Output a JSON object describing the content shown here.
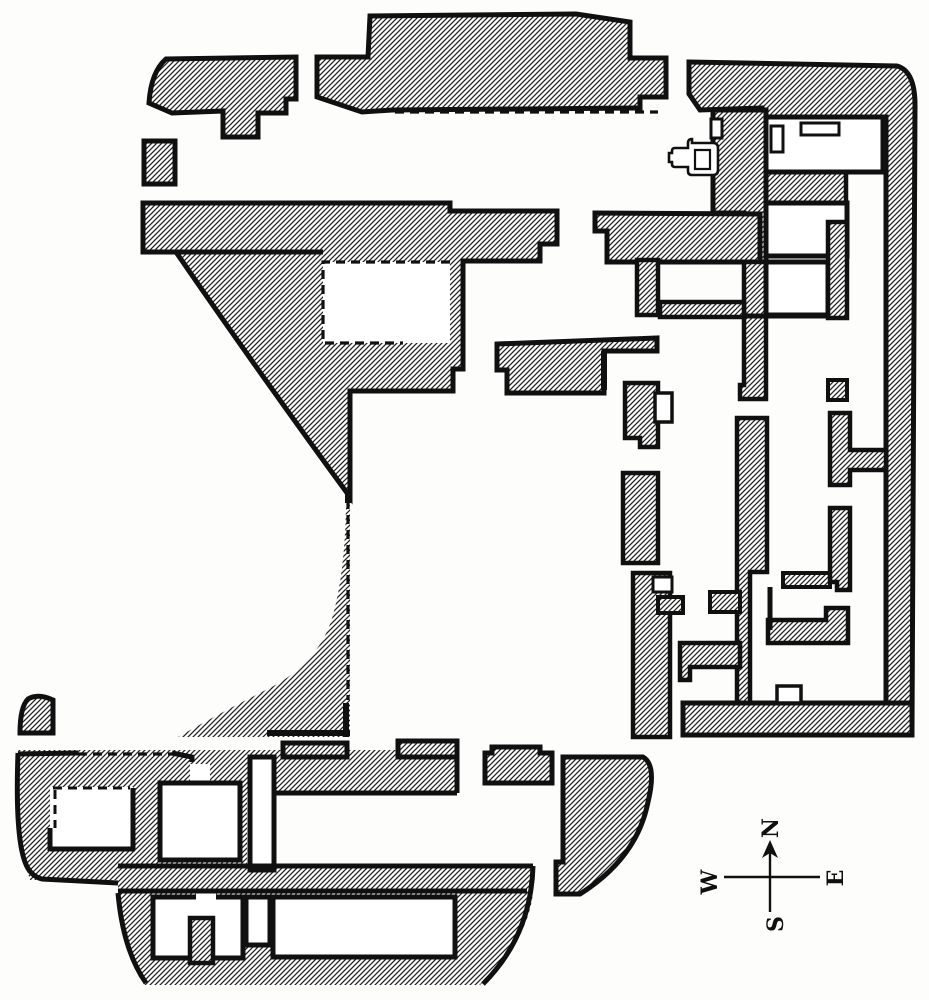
{
  "figure": {
    "title": "Excavated building floor plan (scanned engraving)",
    "canvas": {
      "width": 929,
      "height": 1000
    },
    "colors": {
      "paper": "#fdfdfc",
      "ink": "#101010",
      "hatch_line": "#222222"
    },
    "hatch": {
      "tile": 5,
      "line_width": 1.3,
      "direction": "diagonal-rising-right"
    }
  },
  "compass": {
    "font_size": 22,
    "letters": [
      {
        "dir": "north",
        "char": "N",
        "x": 772,
        "y": 828,
        "rot": -90
      },
      {
        "dir": "south",
        "char": "S",
        "x": 777,
        "y": 924,
        "rot": -90
      },
      {
        "dir": "west",
        "char": "W",
        "x": 711,
        "y": 882,
        "rot": -90
      },
      {
        "dir": "east",
        "char": "E",
        "x": 837,
        "y": 878,
        "rot": -90
      }
    ]
  },
  "plan": {
    "paths": [
      {
        "n": "wall-mass-bottomleft-block-west",
        "d": "M18,750 L160,750 L160,880 L30,880 Q16,840 18,750 Z",
        "f": "hatch",
        "sw": 0
      },
      {
        "n": "wall-mass-bottomleft-block-mid",
        "d": "M133,750 h114 v130 h-114 Z",
        "f": "hatch",
        "sw": 0
      },
      {
        "n": "wall-mass-bottomleft-topband",
        "d": "M18,750 h439 v43 h-439 Z",
        "f": "hatch",
        "sw": 0
      },
      {
        "n": "wall-mass-bottomleft-crossband",
        "d": "M118,866 h415 v27 h-415 Z",
        "f": "hatch",
        "sw": 0
      },
      {
        "n": "wall-mass-bottomleft-lowerblock",
        "d": "M118,893 L533,893 Q528,940 480,985 L145,985 Q125,938 118,893 Z",
        "f": "hatch",
        "sw": 0
      },
      {
        "n": "wall-sliver-courtyard-west",
        "d": "M350,505 L350,737 L178,737 Q225,710 270,688 Q320,662 333,615 Q345,572 346,505 Z",
        "f": "hatch",
        "sw": 0
      },
      {
        "n": "wall-block-northwest",
        "d": "M166,59 L296,57 L296,99 L286,99 L286,113 L258,113 L258,137 L223,137 L223,111 L172,113 L149,103 Q151,72 166,59 Z",
        "f": "hatch",
        "sw": 5
      },
      {
        "n": "wall-square-west",
        "d": "M144,141 h31 v43 h-31 Z",
        "f": "hatch",
        "sw": 5
      },
      {
        "n": "wall-mass-west-range",
        "d": "M143,203 L450,203 L450,211 L557,211 L557,244 L540,244 L540,261 L463,261 L463,369 L453,369 L453,391 L350,391 L350,497 Q298,426 250,358 Q209,300 176,252 L143,252 Z",
        "f": "hatch",
        "sw": 5
      },
      {
        "n": "wall-block-north-center",
        "d": "M317,57 L368,57 L370,16 L576,14 L630,22 L630,58 L666,58 L666,97 L640,97 L640,108 L392,110 L362,112 L317,97 Z",
        "f": "hatch",
        "sw": 5
      },
      {
        "n": "wall-mass-east-margin",
        "d": "M689,62 L897,66 Q915,71 915,105 L912,729 L886,729 L886,117 L762,117 L762,108 L700,110 L689,94 Z",
        "f": "hatch",
        "sw": 5
      },
      {
        "n": "wall-band-under-room1",
        "d": "M766,172 h80 v31 h-80 Z",
        "f": "hatch",
        "sw": 4.5
      },
      {
        "n": "wall-column-hall-east",
        "d": "M713,110 L766,110 L766,262 L744,262 L744,213 L713,213 Z",
        "f": "hatch",
        "sw": 5
      },
      {
        "n": "wall-band-corridor-south-east",
        "d": "M595,213 L760,214 L760,262 L607,262 L607,231 L595,231 Z",
        "f": "hatch",
        "sw": 5
      },
      {
        "n": "wall-vertical-r3",
        "d": "M744,262 L766,262 L766,399 L740,399 L740,385 L744,385 Z",
        "f": "hatch",
        "sw": 4.5
      },
      {
        "n": "wall-vertical-central-tall",
        "d": "M737,418 L767,418 L767,572 L750,572 L750,723 L737,723 Z",
        "f": "hatch",
        "sw": 4.5
      },
      {
        "n": "wall-band-bottom-east",
        "d": "M683,703 L912,703 L912,735 L683,735 Z",
        "f": "hatch",
        "sw": 5
      },
      {
        "n": "wall-strip-left1",
        "d": "M625,383 L658,383 L658,447 L640,447 L640,438 L625,438 Z",
        "f": "hatch",
        "sw": 4.5
      },
      {
        "n": "wall-strip-left2",
        "d": "M623,473 h35 v90 h-35 Z",
        "f": "hatch",
        "sw": 4.5
      },
      {
        "n": "wall-strip-left3",
        "d": "M633,573 h37 v164 h-37 Z",
        "f": "hatch",
        "sw": 4.5
      },
      {
        "n": "wall-arm-left3",
        "d": "M658,597 h25 v16 h-25 Z",
        "f": "hatch",
        "sw": 4
      },
      {
        "n": "wall-arm-a1",
        "d": "M710,592 h30 v20 h-30 Z",
        "f": "hatch",
        "sw": 4
      },
      {
        "n": "wall-arm-a2",
        "d": "M680,643 L740,643 L740,667 L690,667 L690,680 L680,680 Z",
        "f": "hatch",
        "sw": 4.5
      },
      {
        "n": "wall-arm-east",
        "d": "M783,573 h47 v14 h-47 Z",
        "f": "hatch",
        "sw": 4
      },
      {
        "n": "wall-pier-rc1-foot",
        "d": "M828,380 h19 v20 h-19 Z",
        "f": "hatch",
        "sw": 4
      },
      {
        "n": "wall-l-rc2",
        "d": "M830,413 L850,413 L850,450 L886,450 L886,470 L850,470 L850,485 L830,485 Z",
        "f": "hatch",
        "sw": 4.5
      },
      {
        "n": "wall-strip-rc3",
        "d": "M830,508 L850,508 L850,590 L837,590 L837,582 L830,582 Z",
        "f": "hatch",
        "sw": 4.5
      },
      {
        "n": "wall-band-rc4",
        "d": "M768,620 L826,620 L826,608 L848,608 L848,643 L768,643 Z",
        "f": "hatch",
        "sw": 4.5
      },
      {
        "n": "wall-pier-m1",
        "d": "M637,260 h21 v55 h-21 Z",
        "f": "hatch",
        "sw": 4.5
      },
      {
        "n": "wall-band-m3",
        "d": "M660,302 h84 v15 h-84 Z",
        "f": "hatch",
        "sw": 4.5
      },
      {
        "n": "wall-band-mid-south",
        "d": "M497,344 L657,338 L657,351 L604,351 L604,393 L507,393 L507,370 L497,370 Z",
        "f": "hatch",
        "sw": 5
      },
      {
        "n": "wall-bump-top1",
        "d": "M283,743 h64 v14 h-64 Z",
        "f": "hatch",
        "sw": 5
      },
      {
        "n": "wall-bump-top2",
        "d": "M398,741 h59 v16 h-59 Z",
        "f": "hatch",
        "sw": 5
      },
      {
        "n": "wall-pier-detached",
        "d": "M492,747 L540,747 L540,753 L552,753 L552,783 L485,783 L485,753 L492,753 Z",
        "f": "hatch",
        "sw": 5
      },
      {
        "n": "wall-lobe-curved-southeast",
        "d": "M563,757 L643,757 Q657,765 648,802 Q637,858 580,894 L556,894 L556,862 L563,862 Z",
        "f": "hatch",
        "sw": 5
      },
      {
        "n": "wall-corner-piece-west",
        "d": "M20,733 L53,733 L53,700 Q38,693 28,699 Q20,707 20,733 Z",
        "f": "hatch",
        "sw": 5
      },
      {
        "n": "room-restored-dashed",
        "d": "M323,262 h127 v81 h-127 Z",
        "f": "white",
        "sw": 0
      },
      {
        "n": "door-gap-topband",
        "d": "M190,764 h20 v19 h-20 Z",
        "f": "white",
        "sw": 0
      },
      {
        "n": "room-bl-1",
        "d": "M50,787 h83 v64 h-83 Z",
        "f": "white",
        "sw": 0
      },
      {
        "n": "room-bl-2",
        "d": "M160,783 h80 v77 h-80 Z",
        "f": "white",
        "sw": 5
      },
      {
        "n": "passage-bl-1",
        "d": "M250,757 h24 v113 h-24 Z",
        "f": "white",
        "sw": 5
      },
      {
        "n": "room-bl-3",
        "d": "M153,897 h90 v61 h-90 Z",
        "f": "white",
        "sw": 5
      },
      {
        "n": "passage-bl-2",
        "d": "M246,897 h24 v48 h-24 Z",
        "f": "white",
        "sw": 5
      },
      {
        "n": "room-bl-long",
        "d": "M273,897 h182 v60 h-182 Z",
        "f": "white",
        "sw": 5
      },
      {
        "n": "door-notch-room3",
        "d": "M196,889 h20 v16 h-20 Z",
        "f": "white",
        "sw": 0
      },
      {
        "n": "room-tr-1",
        "d": "M766,117 h117 v55 h-117 Z",
        "f": "white",
        "sw": 5
      },
      {
        "n": "room-tr-2",
        "d": "M766,203 h81 v53 h-81 Z",
        "f": "white",
        "sw": 5
      },
      {
        "n": "room-tr-3",
        "d": "M766,262 h62 v53 h-62 Z",
        "f": "white",
        "sw": 5
      },
      {
        "n": "wall-pier-rc1",
        "d": "M828,222 h19 v96 h-19 Z",
        "f": "hatch",
        "sw": 4.5
      },
      {
        "n": "wall-pier-in-room3",
        "d": "M190,918 h23 v45 h-23 Z",
        "f": "hatch",
        "sw": 4.5
      },
      {
        "n": "niche-room-tr-1",
        "d": "M771,126 h12 v26 h-12 Z",
        "f": "white",
        "sw": 3
      },
      {
        "n": "niche-top-room-tr-1",
        "d": "M801,123 h38 v12 h-38 Z",
        "f": "white",
        "sw": 3
      },
      {
        "n": "niche-band-bottom",
        "d": "M777,686 h24 v17 h-24 Z",
        "f": "white",
        "sw": 3.5
      },
      {
        "n": "niche-strip-left1",
        "d": "M655,393 h17 v29 h-17 Z",
        "f": "white",
        "sw": 3.5
      },
      {
        "n": "niche-strip-left3",
        "d": "M653,577 h19 v15 h-19 Z",
        "f": "white",
        "sw": 3
      },
      {
        "n": "door-tick-hall",
        "d": "M711,119 h11 v19 h-11 Z",
        "f": "white",
        "sw": 3
      },
      {
        "n": "outline-bl-top-west",
        "d": "M18,754 L78,753",
        "f": "none",
        "sw": 5
      },
      {
        "n": "outline-bl-top-east",
        "d": "M172,753 L192,757 L192,762",
        "f": "none",
        "sw": 5
      },
      {
        "n": "outline-bl-left-edge",
        "d": "M18,753 Q15,835 25,862 Q30,876 42,879 L118,883",
        "f": "none",
        "sw": 5
      },
      {
        "n": "outline-crossband-top",
        "d": "M118,866 L533,866",
        "f": "none",
        "sw": 5
      },
      {
        "n": "outline-crossband-bottom",
        "d": "M118,891 L527,891",
        "f": "none",
        "sw": 5
      },
      {
        "n": "outline-lower-curve-east",
        "d": "M533,866 Q531,936 483,984",
        "f": "none",
        "sw": 5
      },
      {
        "n": "outline-lower-left-edge",
        "d": "M118,893 Q123,950 146,983",
        "f": "none",
        "sw": 5
      },
      {
        "n": "outline-topband-bottom",
        "d": "M273,793 L457,793 M457,743 L457,793",
        "f": "none",
        "sw": 5
      },
      {
        "n": "outline-westband-bottom",
        "d": "M143,252 L323,252",
        "f": "none",
        "sw": 5
      },
      {
        "n": "outline-room-tr3-bottom",
        "d": "M744,316 L830,316",
        "f": "none",
        "sw": 5
      },
      {
        "n": "outline-stub-east-room",
        "d": "M770,587 L770,630",
        "f": "none",
        "sw": 5
      },
      {
        "n": "outline-stub-bandmid",
        "d": "M604,351 L604,390",
        "f": "none",
        "sw": 6
      },
      {
        "n": "outline-sliver-bottom",
        "d": "M267,733 L350,733 M346,703 L346,737 M348,491 L348,503",
        "f": "none",
        "sw": 6
      },
      {
        "n": "outline-room-bl1",
        "d": "M50,849 L135,849 M133,849 L133,788 M50,828 L50,851",
        "f": "none",
        "sw": 5
      },
      {
        "n": "dashed-wall-north-corridor",
        "d": "M395,112 L658,112",
        "f": "none",
        "sw": 3.2,
        "dash": true
      },
      {
        "n": "dashed-wall-restored-room",
        "d": "M450,262 L323,262 L323,343 L403,343",
        "f": "none",
        "sw": 3.2,
        "dash": true
      },
      {
        "n": "dashed-wall-courtyard",
        "d": "M348,500 L348,700",
        "f": "none",
        "sw": 3.2,
        "dash": true
      },
      {
        "n": "dashed-wall-bl-top",
        "d": "M78,754 L172,754",
        "f": "none",
        "sw": 3.2,
        "dash": true
      },
      {
        "n": "dashed-wall-room-bl1",
        "d": "M53,788 L130,788 M55,790 L55,828",
        "f": "none",
        "sw": 3,
        "dash": true
      },
      {
        "n": "font-symbol-outer",
        "d": "M692,143 h21 q5,0 5,5 v22 q0,5 -5,5 h-21 q-4,0 -4,-4 v-4 h-13 q-3,0 -3,-3 v-2 h-3 v-9 h3 v-2 q0,-3 3,-3 h13 v-5 q0,-4 4,-4 Z",
        "f": "white",
        "sw": 2.6
      },
      {
        "n": "font-symbol-inner",
        "d": "M695,150 h15 v19 h-15 Z",
        "f": "none",
        "sw": 2.2
      },
      {
        "n": "compass-needle-vertical",
        "d": "M770,845 L770,912",
        "f": "none",
        "sw": 2.4
      },
      {
        "n": "compass-needle-horizontal",
        "d": "M724,877 L820,877",
        "f": "none",
        "sw": 2.4
      },
      {
        "n": "compass-arrowhead",
        "d": "M770,840 L762,858 L770,853 L778,858 Z",
        "f": "ink",
        "sw": 0
      }
    ]
  }
}
